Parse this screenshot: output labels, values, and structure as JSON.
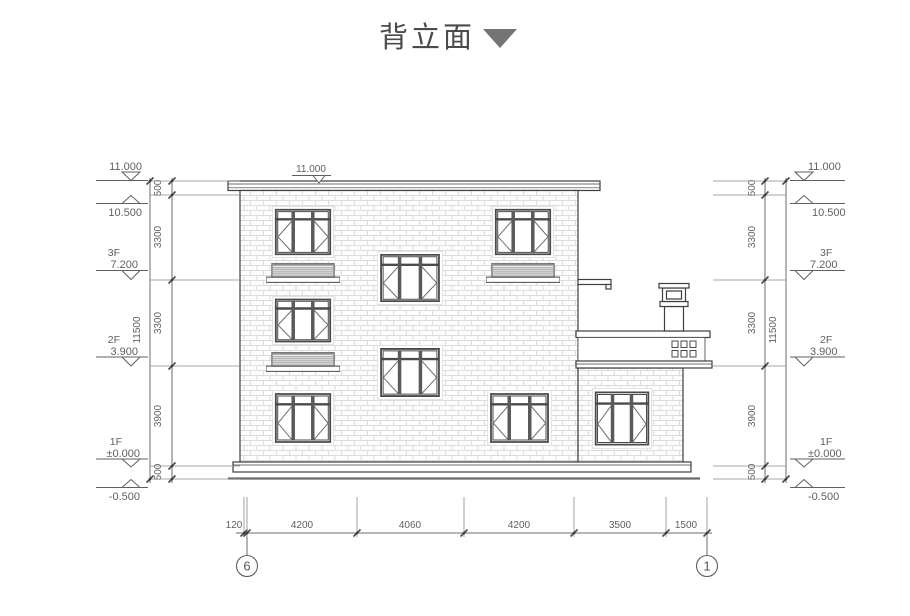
{
  "title": {
    "text": "背立面"
  },
  "elevations": {
    "top": "11.000",
    "parapet": "10.500",
    "f3_label": "3F",
    "f3": "7.200",
    "f2_label": "2F",
    "f2": "3.900",
    "f1_label": "1F",
    "f1": "±0.000",
    "base": "-0.500"
  },
  "vertical_dims": {
    "segments": [
      "500",
      "3300",
      "3300",
      "3900",
      "500"
    ],
    "total": "11500"
  },
  "horizontal_dims": {
    "segments": [
      "120",
      "4200",
      "4060",
      "4200",
      "3500",
      "1500"
    ]
  },
  "grid_bubbles": {
    "left": "6",
    "right": "1"
  },
  "colors": {
    "drawing_line": "#3e3e3e",
    "dimension_line": "#6e6e6e",
    "text": "#5f5f5f",
    "title_text": "#4b4b4b",
    "title_triangle": "#747474",
    "brick_joint": "#dcdcdc"
  }
}
